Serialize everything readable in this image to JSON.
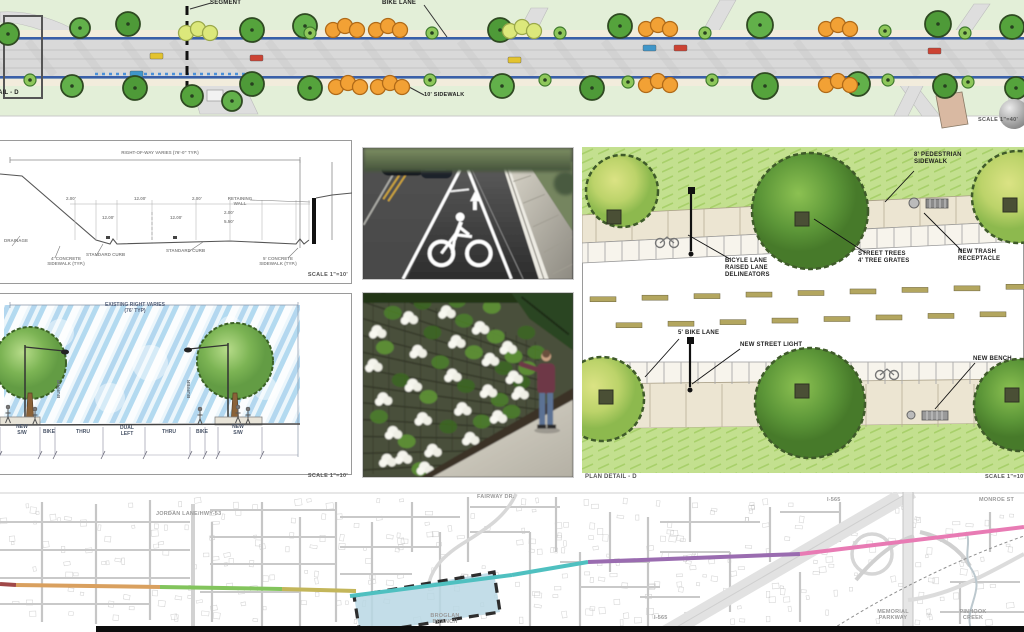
{
  "palette": {
    "grass": "#e3efd8",
    "tree_green": "#55a33c",
    "tree_green_small": "#8ec75a",
    "tree_yellow": "#dce87b",
    "tree_orange": "#f2a135",
    "road_edge_blue": "#3a5fa8",
    "asphalt": "#d9d9d9",
    "sidewalk_beige": "#f2ecdc",
    "detail_grass": "#c3e08f",
    "detail_sidewalk": "#ece5d2",
    "map_segment_fill": "#b9d8e4",
    "corridor_colors": [
      "#a04848",
      "#d9a05f",
      "#82c45c",
      "#c3b65a",
      "#4fc0c0",
      "#9a6cb0",
      "#e87bb4"
    ]
  },
  "top_plan": {
    "segment_label": "SEGMENT",
    "bike_lane_label": "BIKE LANE",
    "sidewalk_label": "10' SIDEWALK",
    "detail_ref_label": "DETAIL - D",
    "scale": "SCALE 1\"=40'"
  },
  "tech_section": {
    "row_label": "RIGHT-OF-WAY VARIES (76'-0\" TYP.)",
    "dims": [
      "2.00'",
      "12.00'",
      "2.00'",
      "12.00'",
      "12.00'",
      "2.00'",
      "5.50'"
    ],
    "callout_drainage": "DRAINAGE",
    "callout_sidewalk_left": "4' CONCRETE\nSIDEWALK (TYP.)",
    "callout_curb_left": "STANDARD CURB",
    "callout_curb_right": "STANDARD CURB",
    "callout_wall": "RETAINING\nWALL",
    "callout_sidewalk_right": "5' CONCRETE\nSIDEWALK (TYP.)",
    "scale": "SCALE 1\"=10'"
  },
  "rendered_section": {
    "title": "EXISTING RIGHT VARIES\n(76' TYP)",
    "buffer_label": "BUFFER",
    "lanes": [
      "NEW\nS/W",
      "BIKE",
      "THRU",
      "DUAL\nLEFT",
      "THRU",
      "BIKE",
      "NEW\nS/W"
    ],
    "scale": "SCALE 1\"=10'"
  },
  "plan_detail": {
    "callout_ped_sidewalk": "8' PEDESTRIAN\nSIDEWALK",
    "callout_bike_delineators": "BICYLE LANE\nRAISED LANE\nDELINEATORS",
    "callout_street_trees": "STREET TREES\n4' TREE GRATES",
    "callout_trash": "NEW TRASH\nRECEPTACLE",
    "callout_bike_lane": "5' BIKE LANE",
    "callout_street_light": "NEW STREET LIGHT",
    "callout_bench": "NEW BENCH",
    "title": "PLAN DETAIL - D",
    "scale": "SCALE 1\"=10'"
  },
  "map": {
    "label_jordan": "JORDAN LANE/HWY-53",
    "label_fairway": "FAIRWAY DR.",
    "label_i565_top": "I-565",
    "label_monroe": "MONROE ST",
    "label_broglan": "BROGLAN\nBRANCH",
    "label_i565_bottom": "I-565",
    "label_memorial": "MEMORIAL\nPARKWAY",
    "label_pinhook": "PINHOOK\nCREEK"
  }
}
